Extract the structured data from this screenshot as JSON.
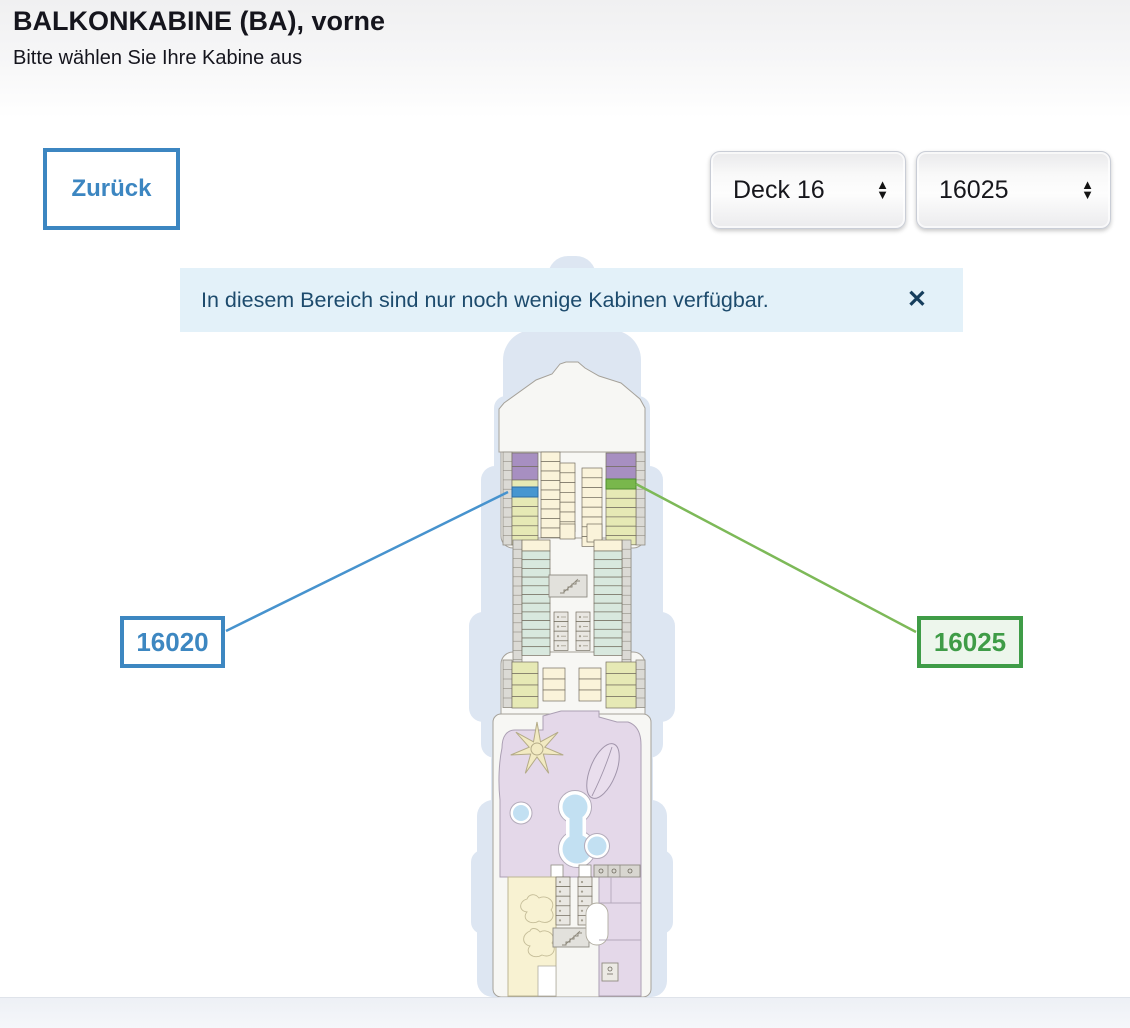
{
  "page": {
    "title": "BALKONKABINE (BA), vorne",
    "subtitle": "Bitte wählen Sie Ihre Kabine aus"
  },
  "toolbar": {
    "back_label": "Zurück"
  },
  "filters": {
    "deck": {
      "value": "Deck 16"
    },
    "cabin": {
      "value": "16025"
    }
  },
  "icons": {
    "select_arrow_up": "▲",
    "select_arrow_down": "▼",
    "close": "✕"
  },
  "banner": {
    "text": "In diesem Bereich sind nur noch wenige Kabinen verfügbar."
  },
  "deck_plan": {
    "labels": {
      "left": "16020",
      "right": "16025"
    },
    "highlighted_cabins": [
      {
        "number": "16020",
        "highlight": "#4796d0",
        "accent": "#3d87c1"
      },
      {
        "number": "16025",
        "highlight": "#79b74c",
        "accent": "#3f9c47"
      }
    ],
    "colors": {
      "silhouette": "#dde6f2",
      "hull_fill": "#f7f7f4",
      "hull_stroke": "#a5a199",
      "row_stroke": "#746e60",
      "strip_fill": "#dbdad5",
      "strip_stroke": "#908c83",
      "balcony_cabin": "#e6e9b5",
      "inside_cabin": "#faf3da",
      "suite": "#a78fc1",
      "mid_cabin": "#d8e8de",
      "utility_cell": "#e9e7e2",
      "stairs_fill": "#e2e1dc",
      "pool_deck": "#e4d8e9",
      "pool_deck_stroke": "#ab9fb3",
      "pool_water": "#c2e0f2",
      "sun_area": "#f8f2d2",
      "sun_area_stroke": "#bdb694",
      "star_fill": "#f2eac2",
      "star_stroke": "#b4ab87",
      "highlight_blue": "#4796d0",
      "highlight_blue_stroke": "#2e6ca3",
      "highlight_green": "#79b74c",
      "highlight_green_stroke": "#4e8c2f",
      "line_blue": "#4793ce",
      "line_green": "#7db958"
    }
  }
}
